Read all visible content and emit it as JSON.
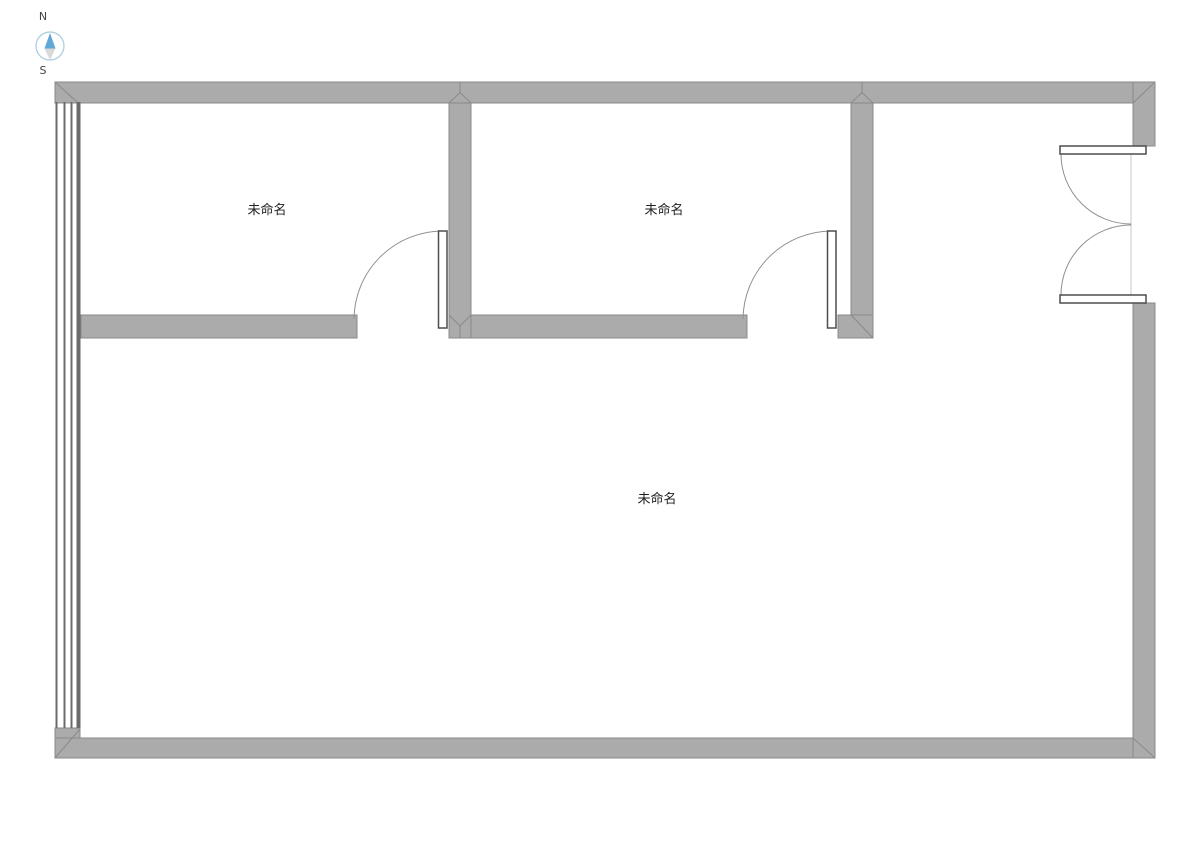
{
  "compass": {
    "north_label": "N",
    "south_label": "S"
  },
  "rooms": [
    {
      "label": "未命名"
    },
    {
      "label": "未命名"
    },
    {
      "label": "未命名"
    }
  ],
  "colors": {
    "background": "#ffffff",
    "wall_fill": "#ababab",
    "wall_outline": "#8a8a8a",
    "door_leaf_outline": "#4d4d4d",
    "swing_arc": "#909090",
    "window_line": "#6b6b6b",
    "opening_line": "#c8c8c8",
    "label_text": "#222222",
    "compass_circle": "#a8cbe0",
    "compass_north": "#5fa8d8",
    "compass_south": "#d9d9d9",
    "compass_text": "#444444"
  }
}
